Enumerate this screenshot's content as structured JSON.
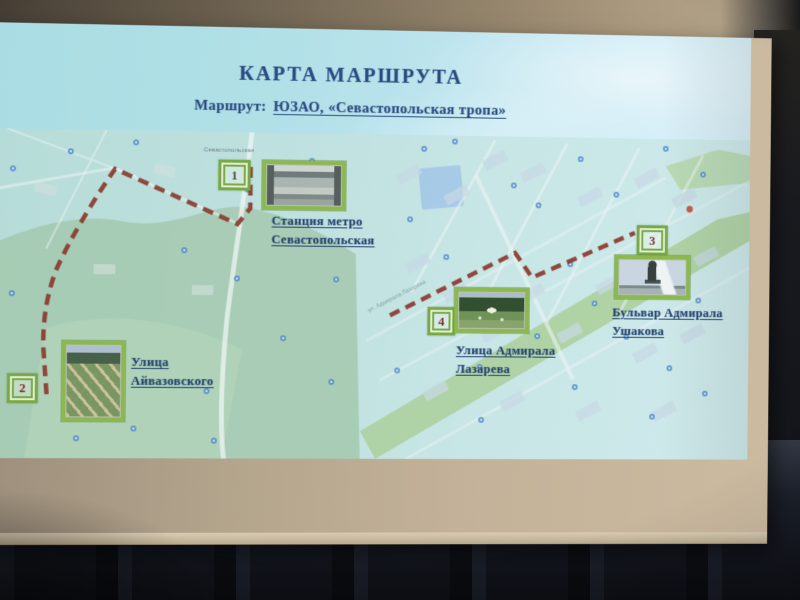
{
  "slide": {
    "title": "КАРТА МАРШРУТА",
    "subtitle_label": "Маршрут:",
    "subtitle_value": "ЮЗАО, «Севастопольская тропа»"
  },
  "map": {
    "street_labels": {
      "metro_top": "Севастопольская",
      "lazareva_street": "ул. Адмирала Лазарева"
    },
    "points": [
      {
        "number": "1",
        "line1": "Станция метро",
        "line2": "Севастопольская",
        "photo": "metro-station-entrance"
      },
      {
        "number": "2",
        "line1": "Улица",
        "line2": "Айвазовского",
        "photo": "park-grid-paths"
      },
      {
        "number": "3",
        "line1": "Бульвар Адмирала",
        "line2": "Ушакова",
        "photo": "ushakov-monument"
      },
      {
        "number": "4",
        "line1": "Улица Адмирала",
        "line2": "Лазарева",
        "photo": "park-fountain"
      }
    ],
    "routes": {
      "left_d": "M267,35 L267,77 L254,93 L129,39 C111,65 84,109 70,142 C60,170 58,192 58,217 L62,268",
      "right_d": "M412,184 L542,119 L560,144 L668,97"
    },
    "colors": {
      "route_dash": "#8a3a2c",
      "marker_green": "#79a944",
      "title_navy": "#2a4b82",
      "number_red": "#7a3028"
    }
  }
}
